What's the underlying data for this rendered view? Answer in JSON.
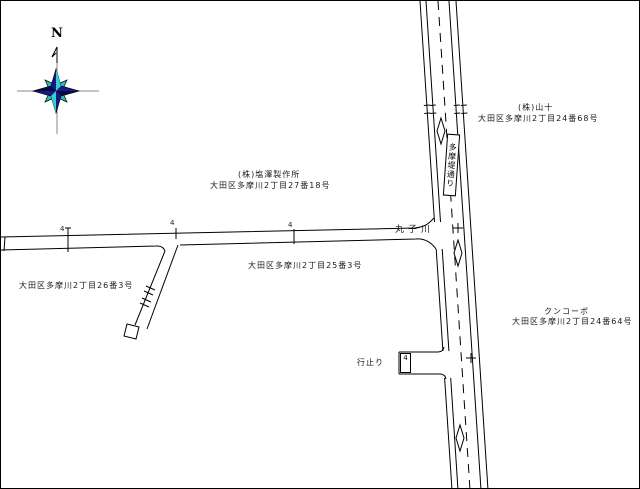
{
  "map": {
    "compass": {
      "north_label": "N"
    },
    "road_plate": {
      "text": "多摩堤通り"
    },
    "labels": {
      "waterway": "丸子川",
      "dead_end": "行止り",
      "yamaju_name": "(株)山十",
      "yamaju_addr": "大田区多摩川2丁目24番68号",
      "shiozawa_name": "(株)塩澤製作所",
      "shiozawa_addr": "大田区多摩川2丁目27番18号",
      "addr_25_3": "大田区多摩川2丁目25番3号",
      "addr_26_3": "大田区多摩川2丁目26番3号",
      "kunkopo_name": "クンコーポ",
      "kunkopo_addr": "大田区多摩川2丁目24番64号"
    },
    "width_markers": [
      "4",
      "4",
      "4",
      "4"
    ],
    "colors": {
      "line": "#000000",
      "background": "#ffffff",
      "compass_navy": "#141a8c",
      "compass_teal": "#2fbdbd",
      "compass_axis": "#8a8a8a"
    }
  }
}
